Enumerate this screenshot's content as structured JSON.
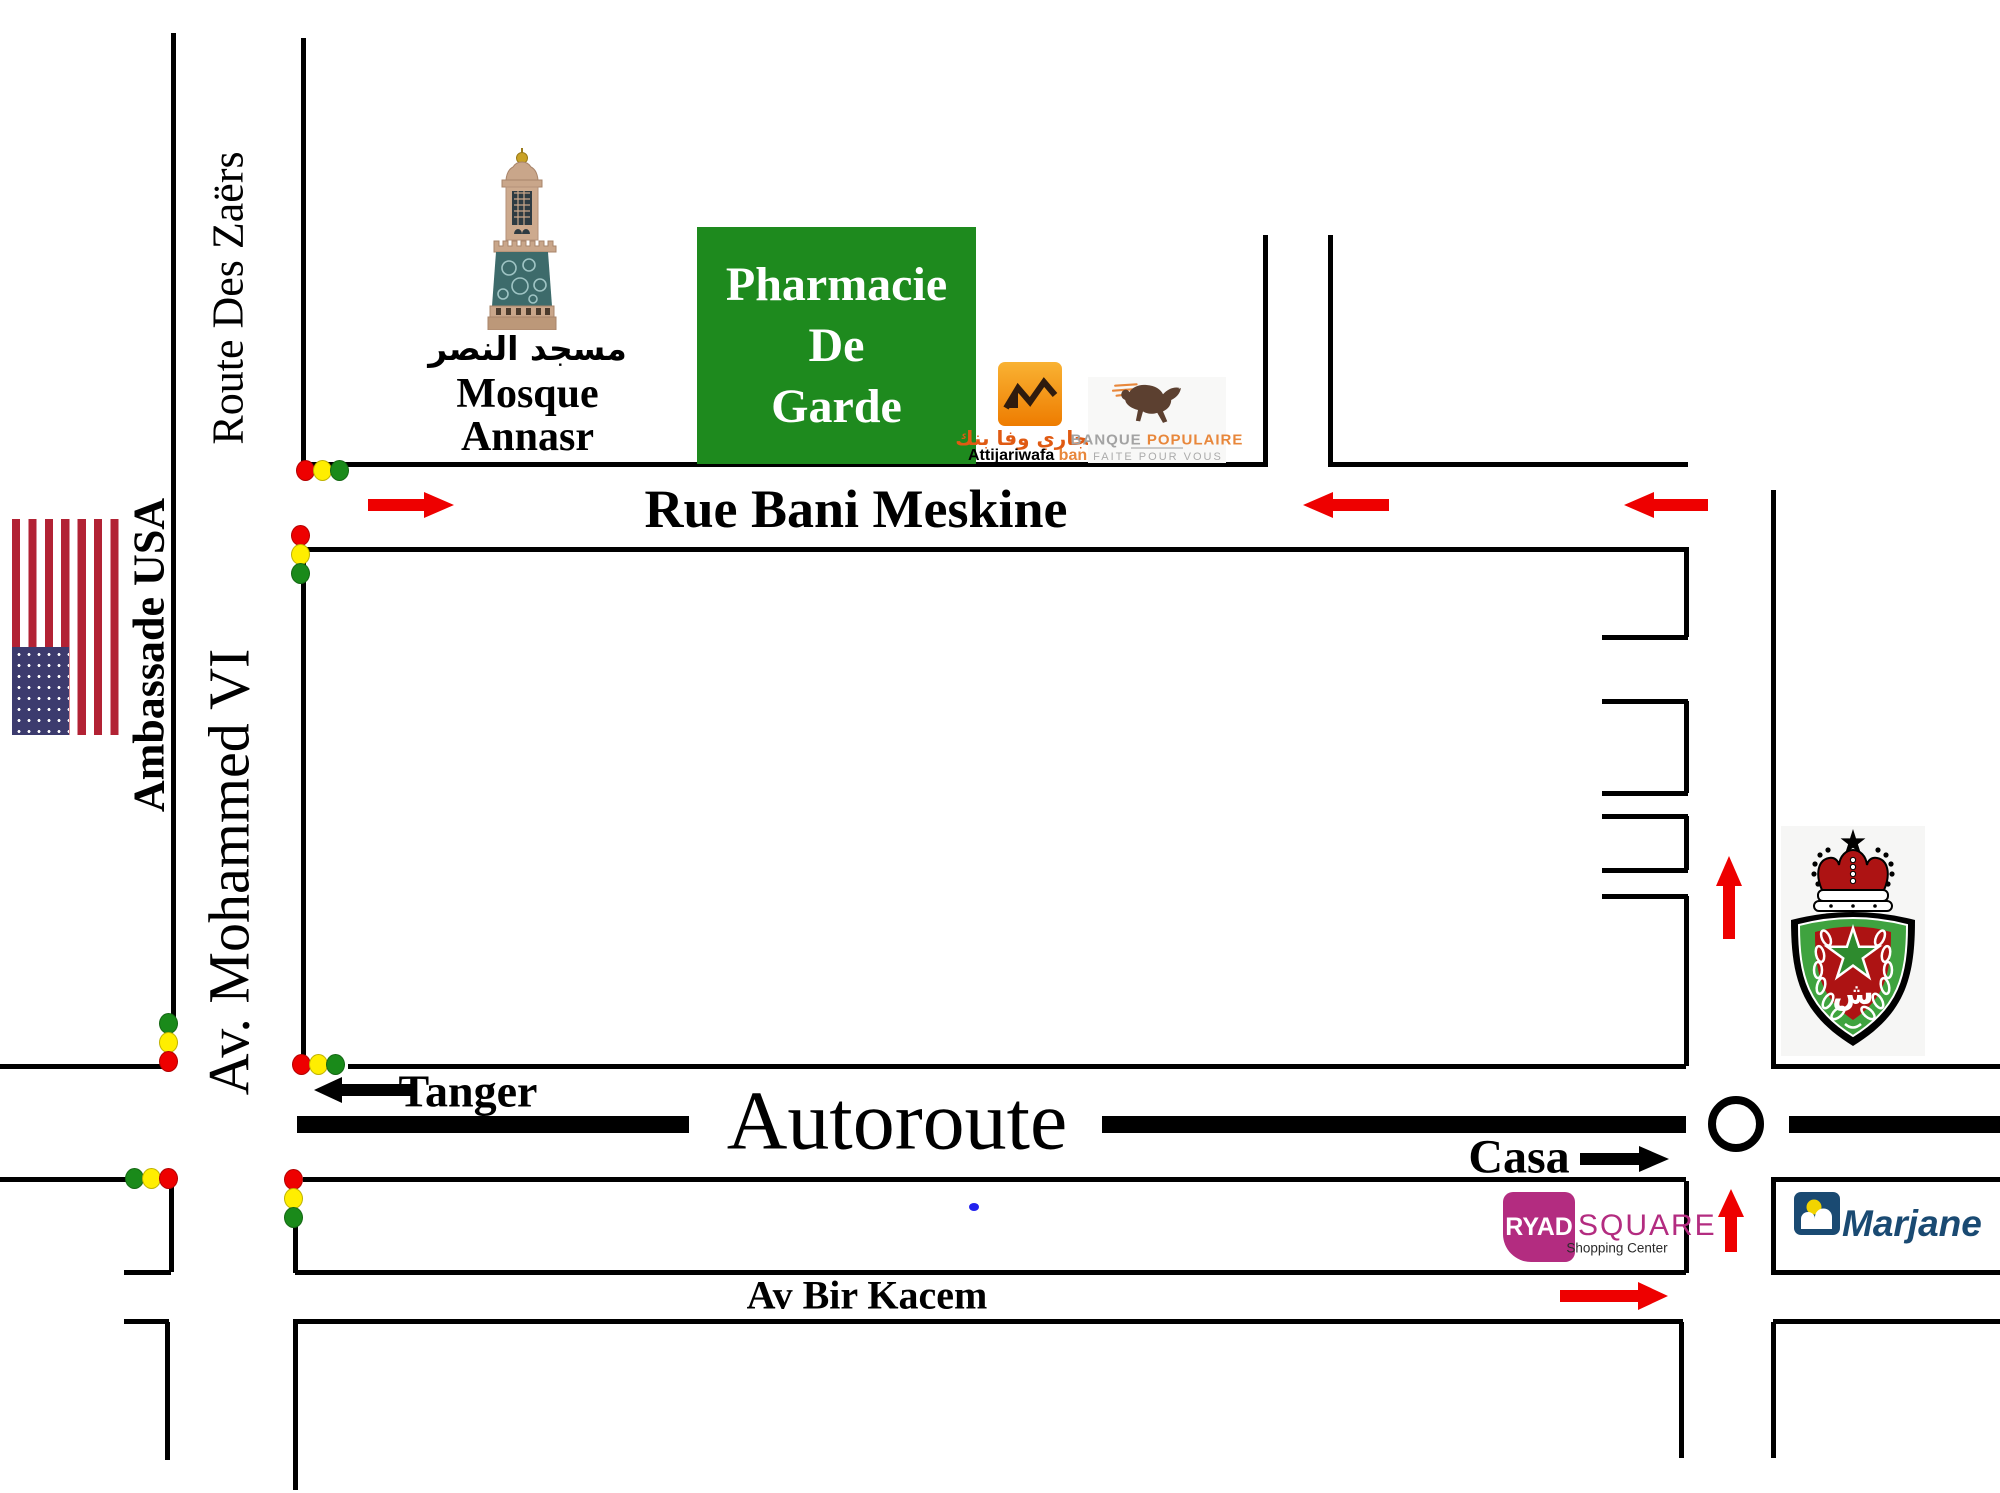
{
  "colors": {
    "road": "#000000",
    "red": "#ee0000",
    "yellow": "#ffee00",
    "green": "#1a8a1a",
    "pharmacy_green": "#1e8a1e",
    "ryad_magenta": "#b32c80",
    "marjane_navy": "#1a4a72",
    "marjane_yellow": "#f2d400",
    "bp_orange": "#e8873b",
    "bp_gray": "#a3a3a3",
    "awb_orange_light": "#f9b233",
    "awb_orange_dark": "#ee7c00",
    "awb_dark": "#2f1b0e",
    "awb_text_orange": "#e05a12",
    "horse_brown": "#5c4030",
    "flag_red": "#b22234",
    "flag_blue": "#3c3b6e",
    "crest_red": "#ad1313",
    "crest_green": "#3fa33f",
    "mosque_tan": "#c9a68a",
    "mosque_teal": "#3d6b6b",
    "blue_dot": "#2222ee"
  },
  "streets": {
    "route_des_zaers": "Route Des Zaërs",
    "ambassade_usa": "Ambassade USA",
    "av_mohammed_vi": "Av. Mohammed VI",
    "rue_bani_meskine": "Rue Bani Meskine",
    "autoroute": "Autoroute",
    "tanger": "Tanger",
    "casa": "Casa",
    "av_bir_kacem": "Av Bir Kacem"
  },
  "landmarks": {
    "mosque": {
      "arabic": "مسجد النصر",
      "name_line1": "Mosque",
      "name_line2": "Annasr"
    },
    "pharmacie": {
      "line1": "Pharmacie",
      "line2": "De",
      "line3": "Garde"
    },
    "attijariwafa": {
      "arabic": "التجاري وفا بنك",
      "name": "Attijariwafa",
      "suffix": "bank"
    },
    "banque_populaire": {
      "brand_gray": "BANQUE",
      "brand_orange": "POPULAIRE",
      "tagline": "FAITE POUR VOUS"
    },
    "ryad_square": {
      "name_box": "RYAD",
      "name_rest": "SQUARE",
      "tagline": "Shopping Center"
    },
    "marjane": {
      "name": "Marjane"
    }
  },
  "icons": {
    "us-flag": "rotated united-states flag, vertical stripes, canton bottom-left",
    "mosque-minaret-icon": "photo of Annasr mosque minaret tower",
    "police-crest-icon": "moroccan surete nationale shield: crown, star, pentagram, laurel",
    "bank-zigzag-icon": "attijariwafa orange square with dark zigzag",
    "horse-icon": "banque populaire galloping horse with orange speed lines",
    "marjane-mark-icon": "navy square, yellow sun, white double arch",
    "roundabout-icon": "white circle with thick black ring",
    "traffic-light-dot": "red / yellow / green ellipse",
    "arrow-icon": "direction arrow (red = traffic flow, black = destination)",
    "blue-dot": "small blue mark"
  }
}
